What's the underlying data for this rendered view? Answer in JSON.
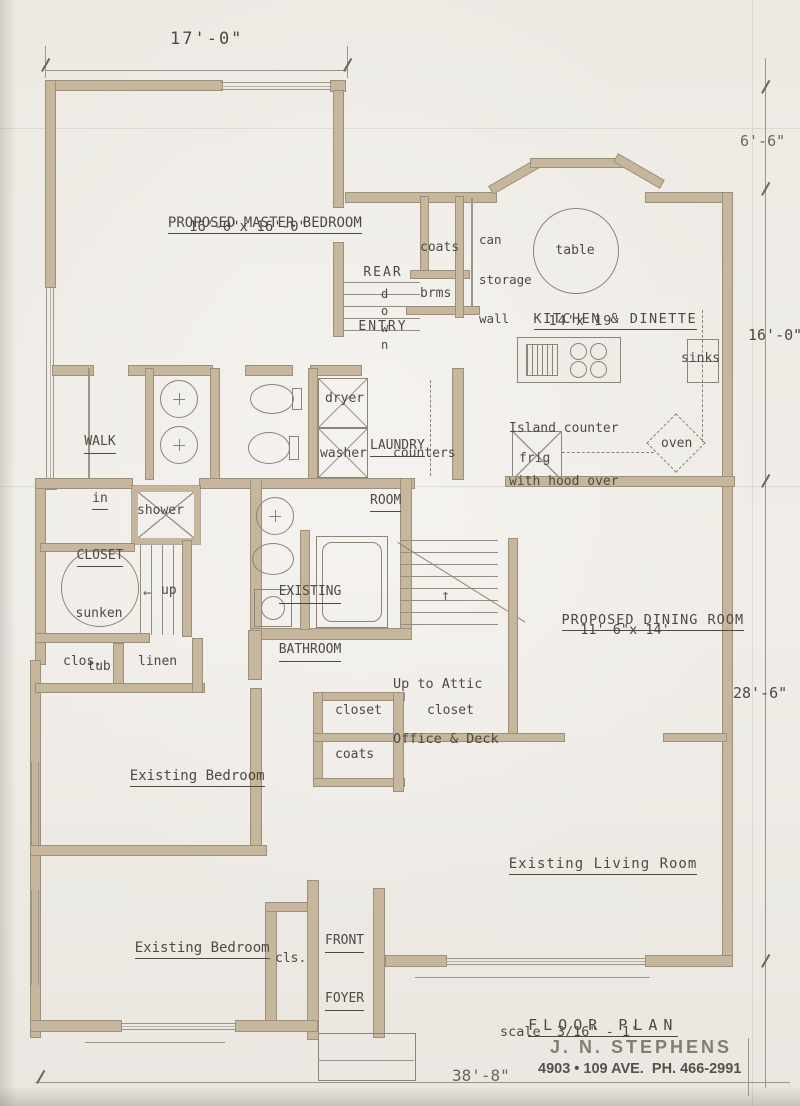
{
  "drawing": {
    "title": "FLOOR PLAN",
    "scale": "scale  3/16\" - 1'",
    "stamp_name": "J. N. STEPHENS",
    "stamp_address": "4903 • 109 AVE.  PH. 466-2991"
  },
  "dimensions": {
    "top_width": "17'-0\"",
    "right_upper": "6'-6\"",
    "right_mid": "16'-0\"",
    "right_lower": "28'-6\"",
    "bottom_width": "38'-8\""
  },
  "rooms": {
    "master_bedroom": {
      "name": "PROPOSED MASTER BEDROOM",
      "size": "16'-0\"x 16'-0\""
    },
    "rear_entry": {
      "line1": "REAR",
      "line2": "ENTRY"
    },
    "kitchen": {
      "name": "KITCHEN & DINETTE",
      "size": "14'x 19'"
    },
    "laundry": {
      "line1": "LAUNDRY",
      "line2": "ROOM"
    },
    "walk_in_closet": {
      "line1": "WALK",
      "line2": "in",
      "line3": "CLOSET"
    },
    "bathroom": {
      "line1": "EXISTING",
      "line2": "BATHROOM"
    },
    "dining": {
      "name": "PROPOSED DINING ROOM",
      "size": "11'-6\"x 14'"
    },
    "bedroom_upper": {
      "name": "Existing Bedroom"
    },
    "bedroom_lower": {
      "name": "Existing Bedroom"
    },
    "living": {
      "name": "Existing Living Room"
    },
    "foyer": {
      "line1": "FRONT",
      "line2": "FOYER"
    }
  },
  "labels": {
    "coats_rear": "coats",
    "brooms": "brms",
    "down": "down",
    "can_storage": {
      "line1": "can",
      "line2": "storage",
      "line3": "wall"
    },
    "table": "table",
    "sinks": "sinks",
    "island": {
      "line1": "Island counter",
      "line2": "with hood over"
    },
    "frig": "frig",
    "oven": "oven",
    "dryer": "dryer",
    "washer": "washer",
    "counters": "counters",
    "shower": "shower",
    "sunken_tub": {
      "line1": "sunken",
      "line2": "tub"
    },
    "up": "up",
    "up_arrow": "←",
    "attic_arrow": "↑",
    "attic": {
      "line1": "Up to Attic",
      "line2": "Office & Deck"
    },
    "closet_small": "closet",
    "closet_hall": "closet",
    "coats_front": "coats",
    "clos": "clos.",
    "linen": "linen",
    "cls": "cls."
  }
}
